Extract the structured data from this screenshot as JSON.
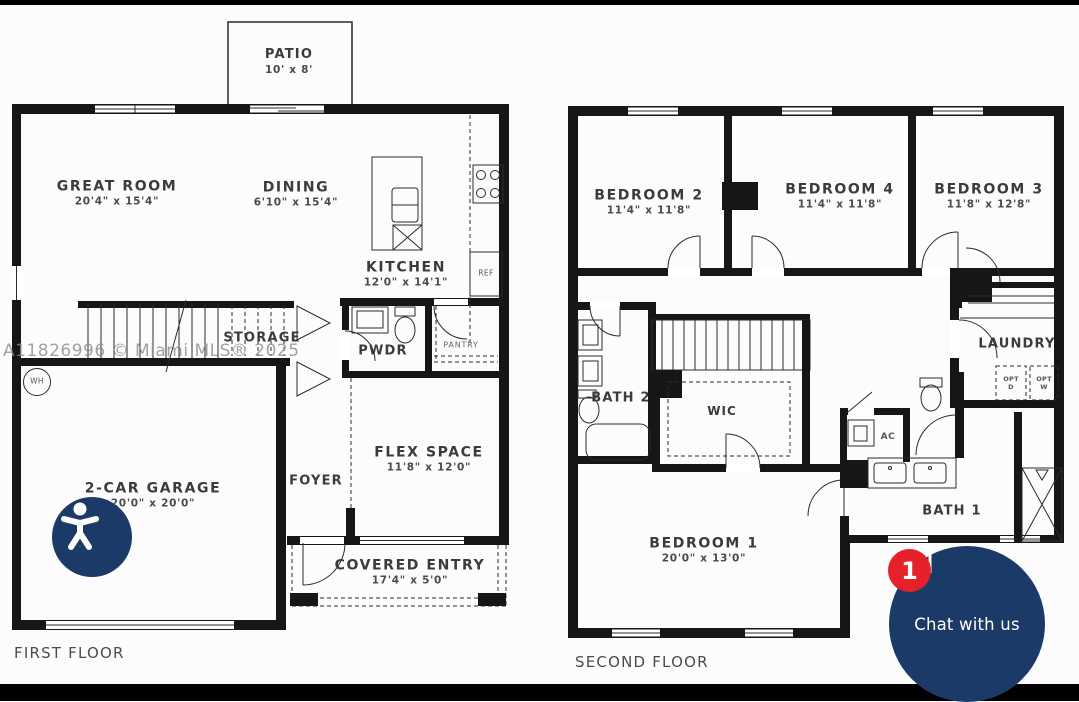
{
  "first_floor": {
    "title": "FIRST FLOOR",
    "patio": {
      "name": "PATIO",
      "dims": "10' x 8'"
    },
    "great_room": {
      "name": "GREAT ROOM",
      "dims": "20'4\" x 15'4\""
    },
    "dining": {
      "name": "DINING",
      "dims": "6'10\" x 15'4\""
    },
    "kitchen": {
      "name": "KITCHEN",
      "dims": "12'0\" x 14'1\""
    },
    "storage": {
      "name": "STORAGE"
    },
    "powder_room": {
      "name": "PWDR"
    },
    "pantry": {
      "name": "PANTRY"
    },
    "refrigerator": {
      "name": "REF"
    },
    "water_heater": {
      "name": "WH"
    },
    "flex_space": {
      "name": "FLEX SPACE",
      "dims": "11'8\" x 12'0\""
    },
    "foyer": {
      "name": "FOYER"
    },
    "garage": {
      "name": "2-CAR GARAGE",
      "dims": "20'0\" x 20'0\""
    },
    "covered_entry": {
      "name": "COVERED ENTRY",
      "dims": "17'4\" x 5'0\""
    }
  },
  "second_floor": {
    "title": "SECOND FLOOR",
    "bedroom_2": {
      "name": "BEDROOM 2",
      "dims": "11'4\" x 11'8\""
    },
    "bedroom_4": {
      "name": "BEDROOM 4",
      "dims": "11'4\" x 11'8\""
    },
    "bedroom_3": {
      "name": "BEDROOM 3",
      "dims": "11'8\" x 12'8\""
    },
    "bedroom_1": {
      "name": "BEDROOM 1",
      "dims": "20'0\" x 13'0\""
    },
    "bath_2": {
      "name": "BATH 2"
    },
    "bath_1": {
      "name": "BATH 1"
    },
    "wic": {
      "name": "WIC"
    },
    "laundry": {
      "name": "LAUNDRY"
    },
    "opt_dryer": {
      "line1": "OPT",
      "line2": "D"
    },
    "opt_washer": {
      "line1": "OPT",
      "line2": "W"
    },
    "ac": {
      "name": "AC"
    }
  },
  "watermark": {
    "text": "A11826996 © Miami MLS® 2025"
  },
  "chat_widget": {
    "label": "Chat with us",
    "badge_count": "1",
    "button_color": "#1c3a67",
    "badge_color": "#e62129"
  },
  "accessibility_widget": {
    "button_color": "#1c3a67"
  }
}
